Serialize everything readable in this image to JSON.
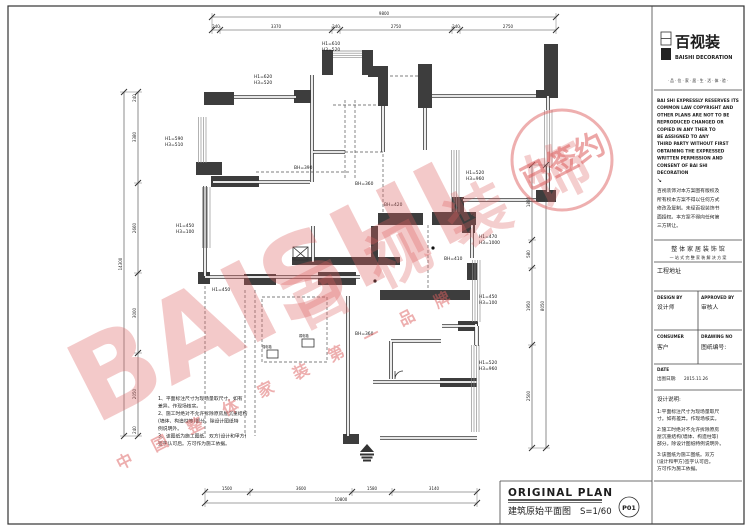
{
  "sheet": {
    "bg": "#ffffff",
    "line_color": "#333333",
    "wall_fill": "#3d3d3d",
    "watermark_color": "#dd5f5f",
    "accent_red": "#b5342c"
  },
  "logo": {
    "cn": "百视装",
    "en": "BAISHI  DECORATION",
    "tagline": "· 品 · 位 · 家 · 居 · 生 · 活 · 体 · 验 ·"
  },
  "copyright_en": [
    "BAI SHI EXPRESSLY RESERVES ITS",
    "COMMON LAW COPYRIGHT AND",
    "OTHER PLANS ARE NOT TO BE",
    "REPRODUCED CHANGED OR",
    "COPIED IN ANY THER TO",
    "BE ASSIGNED TO ANY",
    "THIRD PARTY WITHOUT FIRST",
    "OBTAINING THE EXPRESSED",
    "WRITTEN PERMISSION AND",
    "CONSENT OF BAI SHI",
    "DECORATION"
  ],
  "copyright_cn": [
    "百视装饰对本方案图有版权及",
    "所有权本方案不得以任何方式",
    "修改及复制。未经百视装饰书",
    "面授权。本方案不得向任何第",
    "三方转让。"
  ],
  "arrow_glyph": "↘",
  "slogans": {
    "line1": "整 体 家 居 装 饰 馆",
    "line2": "一 站 式 完 整 家 装 解 决 方 案"
  },
  "address_label": "工程地址",
  "fields": {
    "design_by": "DESIGN BY",
    "designer": "设计师",
    "approved_by": "APPROVED BY",
    "approver": "审核人",
    "consumer": "CONSUMER",
    "client": "客户",
    "drawing_no": "DRAWING NO",
    "drawing_no_cn": "图纸编号:",
    "date": "DATE",
    "date_cn": "出图日期:",
    "date_value": "2015.11.26"
  },
  "design_notes": {
    "title": "设计说明:",
    "lines": [
      "1:平面标注尺寸为现场量取尺",
      "寸。如有差异。作现场核实。",
      "2:施工时绝对不允许拆除原房",
      "屋沉重结构(墙体、构造柱等)",
      "部分。除设计图纸特例说明外。",
      "3:该图纸为施工图纸。双方",
      "(设计和甲方)签字认可后。",
      "方可作为施工依据。"
    ]
  },
  "plan_notes": [
    "1、平面标注尺寸为现场量取尺寸。如有",
    "差异。作现场核实。",
    "2、施工时绝对不允许拆除原房屋沉重结构",
    "(墙体、构造柱等)部分。除设计图纸特",
    "例说明外。",
    "3、该图纸为施工图纸。双方(设计和甲方)",
    "签字认可后。方可作为施工依据。"
  ],
  "title_block": {
    "en": "ORIGINAL PLAN",
    "cn": "建筑原始平面图",
    "scale": "S=1/60",
    "page": "P01"
  },
  "watermark": {
    "en": "BAISHI",
    "cn": "百视装饰",
    "sub": "中 国 整 体 家 装 第 一 品 牌",
    "stamp": "已签约"
  },
  "labels": {
    "l1a": "H1=610",
    "l1b": "H3=520",
    "l2a": "H1=620",
    "l2b": "H3=520",
    "l3a": "H1=590",
    "l3b": "H3=510",
    "l4": "BH=390",
    "l5": "BH=360",
    "l6": "BH=420",
    "l7a": "H1=520",
    "l7b": "H3=960",
    "l8a": "H1=470",
    "l8b": "H3=1000",
    "l9": "BH=410",
    "l10a": "H1=450",
    "l10b": "H3=100",
    "l11a": "H1=520",
    "l11b": "H3=960",
    "l12a": "H1=450",
    "l12b": "H3=100",
    "l13": "H1=450",
    "l14": "BH=360",
    "box1": "强电箱",
    "box2": "弱电箱"
  },
  "dims": {
    "wall": "240",
    "top": {
      "total": "9800",
      "s1": "3370",
      "s2": "2750",
      "s3": "2750"
    },
    "left": {
      "total": "14300",
      "s1": "3380",
      "s2": "2660",
      "s3": "3000",
      "s4": "2050"
    },
    "right": {
      "total": "8050",
      "s1": "1880",
      "s2": "580",
      "s3": "1950",
      "s4": "2500"
    },
    "bottom": {
      "total": "10800",
      "s1": "1500",
      "s2": "3600",
      "s3": "1580",
      "s4": "3140"
    }
  }
}
